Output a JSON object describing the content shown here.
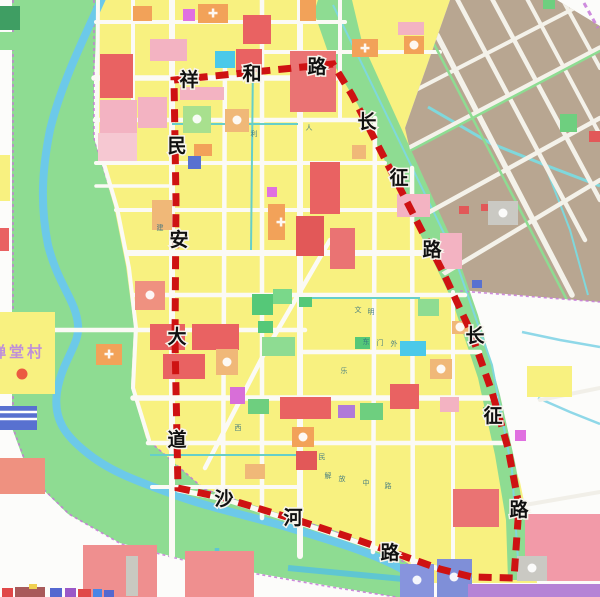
{
  "map": {
    "village_label": "禅堂村",
    "boundary_labels": {
      "xianghe": [
        "祥",
        "和",
        "路"
      ],
      "minan": [
        "民",
        "安",
        "大",
        "道"
      ],
      "changzheng_upper": [
        "长",
        "征",
        "路"
      ],
      "changzheng_lower": [
        "长",
        "征",
        "路"
      ],
      "shahe": [
        "沙",
        "河",
        "路"
      ]
    },
    "road_names": {
      "north": "祥和路",
      "west": "民安大道",
      "east": "长征路",
      "south": "沙河路"
    },
    "micro_street_labels": [
      "东",
      "门",
      "外",
      "文",
      "明",
      "乐",
      "民",
      "解",
      "放",
      "中",
      "路",
      "西",
      "建",
      "利",
      "人"
    ],
    "colors": {
      "boundary_red": "#ce1212",
      "planning_yellow": "#f8f180",
      "built_up_tan": "#b8a691",
      "corridor_green": "#8edc92",
      "park_green": "#55c878",
      "river_blue": "#6cc9e9",
      "commercial_red": "#e96262",
      "residential_pink": "#f3b3c2",
      "public_orange": "#f2a259",
      "water_cyan": "#4ac9e9",
      "village_label_purple": "#bf8fd9",
      "road_white": "#fbfaf5"
    }
  }
}
